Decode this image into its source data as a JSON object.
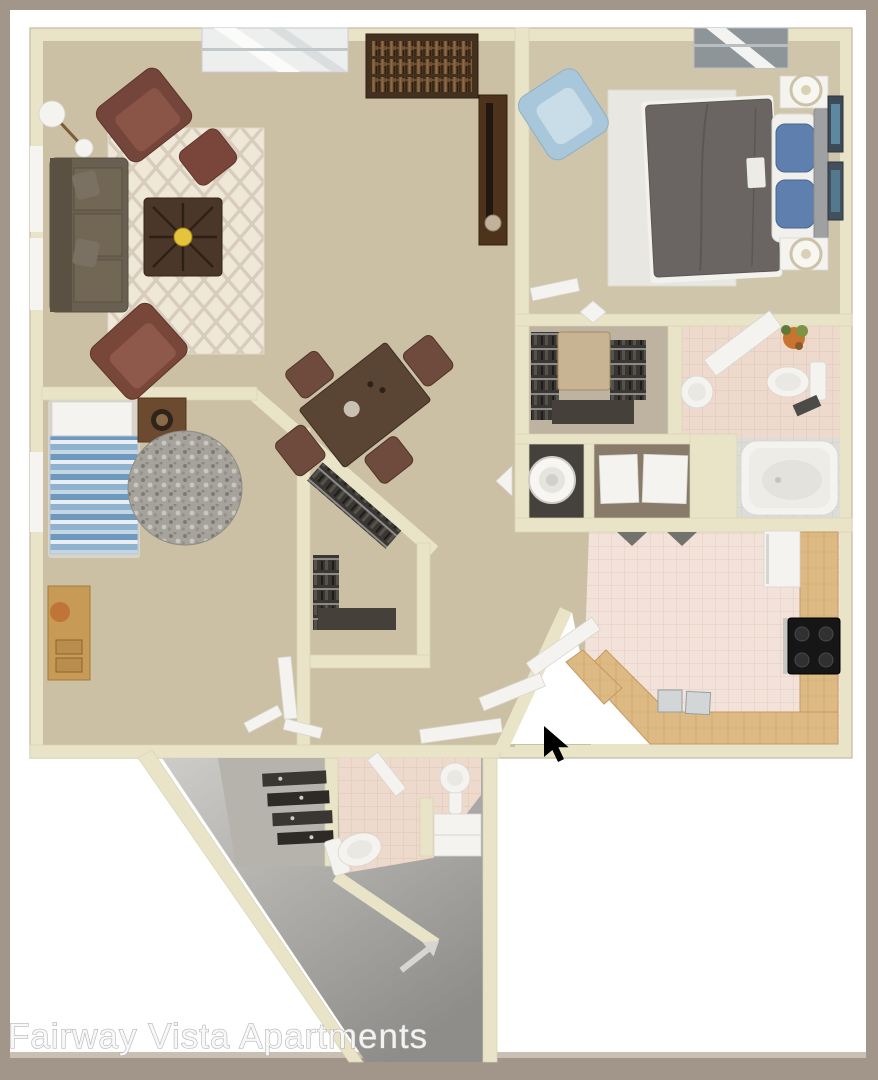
{
  "watermark": {
    "text": "Fairway Vista Apartments"
  },
  "rooms": [
    "living-room",
    "dining-area",
    "master-bedroom",
    "second-bedroom",
    "walk-in-closet",
    "hall-closet",
    "laundry-closet",
    "master-bathroom",
    "kitchen",
    "entry-hall",
    "entry-closet",
    "guest-bathroom"
  ],
  "palette": {
    "frame": "#A29589",
    "matte": "#FFFFFF",
    "wall": "#E9E4C7",
    "carpet": "#CBC0A4",
    "bedroomCarpet": "#CFC5AB",
    "closetFloor": "#BDB3A0",
    "grayFloor": "#C6C5C1",
    "grayFloorDark": "#8E8D89",
    "tilePink": "#EDDACD",
    "tileGray": "#DDDCD8",
    "kitchenTile": "#F3E2D9",
    "counterWood": "#DDBA83",
    "rugCream": "#EFE8D8",
    "rugWhite": "#E9E7E2",
    "roundRug": "#A6A29C",
    "sofaBrown": "#696052",
    "chairRust": "#79473A",
    "tableWood": "#4A3729",
    "diningWood": "#5A4433",
    "comforter": "#6A6562",
    "pillowBlue": "#5F7FAE",
    "blueChair": "#A9C7DB",
    "clothes": "#3A3733",
    "fixtureWhite": "#F4F3F0",
    "stove": "#161616",
    "accentGold": "#E5C43C",
    "cursor": "#000000",
    "watermarkColor": "#F8F8F8"
  }
}
